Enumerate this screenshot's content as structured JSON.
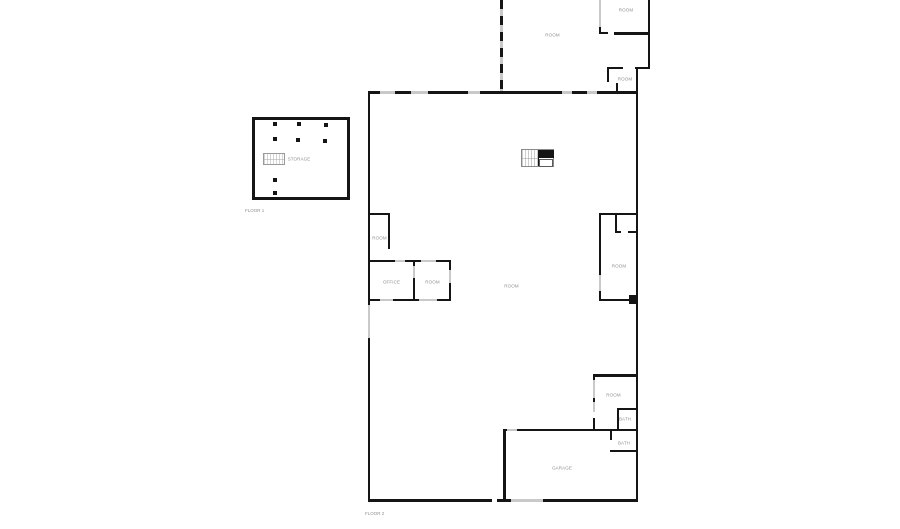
{
  "colors": {
    "wall": "#151515",
    "window": "#c9c9c9",
    "label": "#8f8f8f",
    "background": "#ffffff"
  },
  "floor1": {
    "name": "FLOOR 1",
    "rooms": [
      {
        "id": "storage",
        "label": "STORAGE"
      }
    ]
  },
  "floor2": {
    "name": "FLOOR 2",
    "rooms": [
      {
        "id": "upper-room",
        "label": "ROOM"
      },
      {
        "id": "upper-right-room",
        "label": "ROOM"
      },
      {
        "id": "upper-back-room",
        "label": "ROOM"
      },
      {
        "id": "left-small-room",
        "label": "ROOM"
      },
      {
        "id": "office",
        "label": "OFFICE"
      },
      {
        "id": "room-beside-office",
        "label": "ROOM"
      },
      {
        "id": "great-room",
        "label": "ROOM"
      },
      {
        "id": "middle-right-room",
        "label": "ROOM"
      },
      {
        "id": "lower-right-room",
        "label": "ROOM"
      },
      {
        "id": "bath-upper",
        "label": "BATH"
      },
      {
        "id": "bath-lower",
        "label": "BATH"
      },
      {
        "id": "garage",
        "label": "GARAGE"
      }
    ]
  }
}
